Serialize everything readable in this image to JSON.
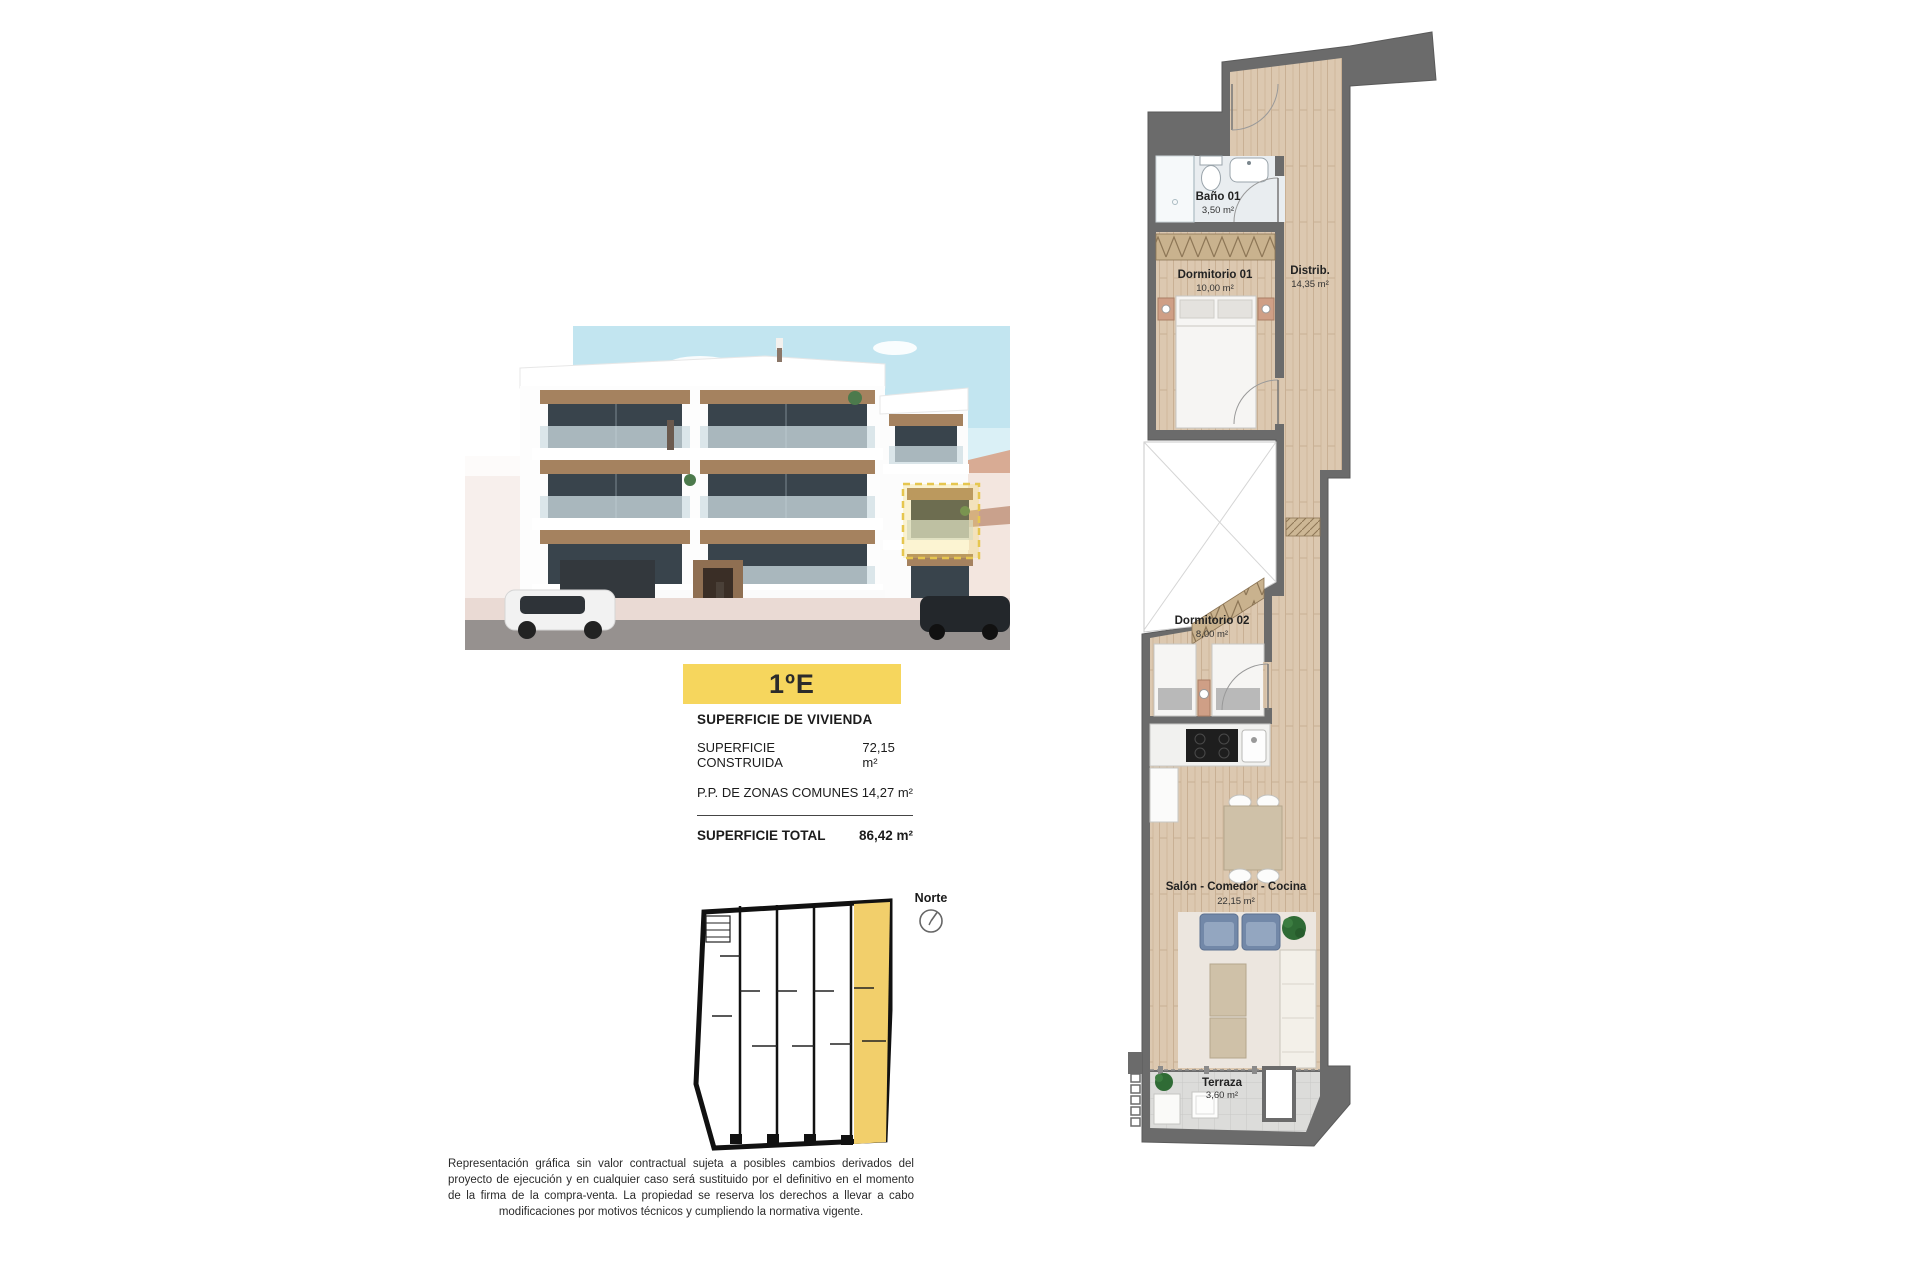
{
  "unit_label": "1ºE",
  "surface": {
    "title": "SUPERFICIE DE VIVIENDA",
    "row1_label": "SUPERFICIE CONSTRUIDA",
    "row1_value": "72,15 m²",
    "row2_label": "P.P. DE ZONAS COMUNES",
    "row2_value": "14,27 m²",
    "total_label": "SUPERFICIE TOTAL",
    "total_value": "86,42 m²"
  },
  "north_label": "Norte",
  "floorplan": {
    "rooms": {
      "bano": {
        "name": "Baño 01",
        "area": "3,50 m²"
      },
      "dorm1": {
        "name": "Dormitorio 01",
        "area": "10,00 m²"
      },
      "distrib": {
        "name": "Distrib.",
        "area": "14,35 m²"
      },
      "dorm2": {
        "name": "Dormitorio 02",
        "area": "8,00 m²"
      },
      "salon": {
        "name": "Salón - Comedor - Cocina",
        "area": "22,15 m²"
      },
      "terraza": {
        "name": "Terraza",
        "area": "3,60 m²"
      }
    }
  },
  "disclaimer": "Representación gráfica sin valor contractual sujeta a posibles cambios derivados del proyecto de ejecución y en cualquier caso será sustituido por el definitivo en el momento de la firma de la compra-venta. La propiedad se reserva los derechos a llevar a cabo modificaciones por motivos técnicos y cumpliendo la normativa vigente.",
  "colors": {
    "accent_yellow": "#f6d65d",
    "keyplan_yellow": "#f2cf6b",
    "wall_gray": "#6b6b6b",
    "wood": "#dcc8b0",
    "sky": "#c2e5f0"
  }
}
